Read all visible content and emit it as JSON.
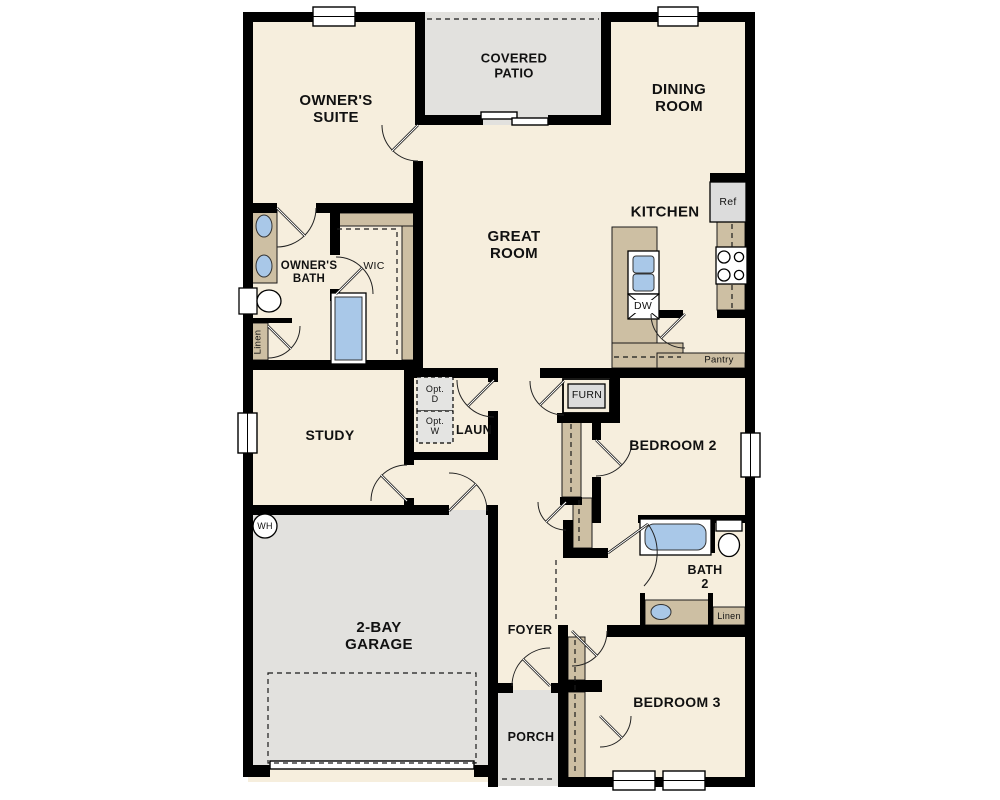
{
  "colors": {
    "wall": "#000000",
    "floor": "#f6eedd",
    "outdoor": "#e2e1de",
    "casework": "#cdbfa3",
    "fixture": "#a9c8e8",
    "appliance": "#dcdcdc"
  },
  "labels": {
    "covered_patio": [
      "COVERED",
      "PATIO"
    ],
    "owners_suite": [
      "OWNER'S",
      "SUITE"
    ],
    "dining_room": [
      "DINING",
      "ROOM"
    ],
    "great_room": [
      "GREAT",
      "ROOM"
    ],
    "kitchen": "KITCHEN",
    "owners_bath": [
      "OWNER'S",
      "BATH"
    ],
    "wic": "WIC",
    "linen_owners": "Linen",
    "study": "STUDY",
    "laun": "LAUN",
    "opt_d": [
      "Opt.",
      "D"
    ],
    "opt_w": [
      "Opt.",
      "W"
    ],
    "furn": "FURN",
    "ref": "Ref",
    "dw": "DW",
    "pantry": "Pantry",
    "bedroom2": "BEDROOM 2",
    "bath2": [
      "BATH",
      "2"
    ],
    "linen_bath2": "Linen",
    "wh": "WH",
    "garage": [
      "2-BAY",
      "GARAGE"
    ],
    "foyer": "FOYER",
    "porch": "PORCH",
    "bedroom3": "BEDROOM 3"
  }
}
